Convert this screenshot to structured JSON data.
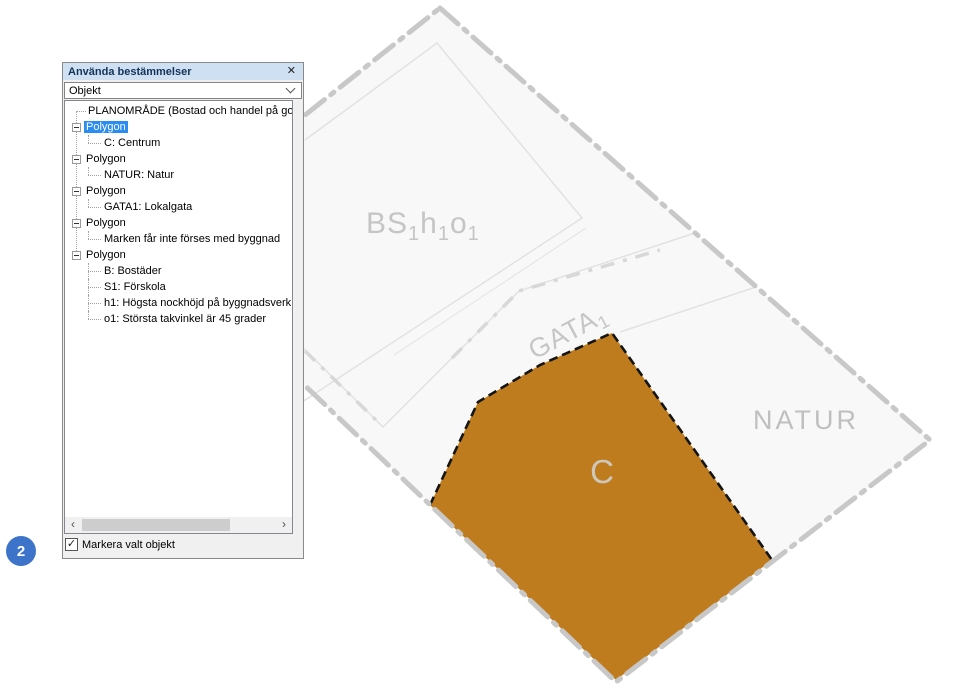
{
  "panel": {
    "title": "Använda bestämmelser",
    "object_selector": {
      "value": "Objekt"
    },
    "checkbox": {
      "label": "Markera valt objekt",
      "checked": true
    },
    "icons": {
      "close": "✕",
      "check": "✓",
      "scroll_left": "‹",
      "scroll_right": "›"
    }
  },
  "tree": {
    "items": [
      {
        "label": "PLANOMRÅDE (Bostad och handel på golfba",
        "type": "plain",
        "selected": false
      },
      {
        "label": "Polygon",
        "type": "node",
        "selected": true
      },
      {
        "label": "C: Centrum",
        "type": "leaf",
        "selected": false
      },
      {
        "label": "Polygon",
        "type": "node",
        "selected": false
      },
      {
        "label": "NATUR: Natur",
        "type": "leaf",
        "selected": false
      },
      {
        "label": "Polygon",
        "type": "node",
        "selected": false
      },
      {
        "label": "GATA1: Lokalgata",
        "type": "leaf",
        "selected": false
      },
      {
        "label": "Polygon",
        "type": "node",
        "selected": false
      },
      {
        "label": "Marken får inte förses med byggnad",
        "type": "leaf",
        "selected": false
      },
      {
        "label": "Polygon",
        "type": "node",
        "selected": false
      },
      {
        "label": "B: Bostäder",
        "type": "leaf",
        "selected": false
      },
      {
        "label": "S1: Förskola",
        "type": "leaf",
        "selected": false
      },
      {
        "label": "h1: Högsta nockhöjd på byggnadsverk",
        "type": "leaf",
        "selected": false
      },
      {
        "label": "o1: Största takvinkel är 45 grader",
        "type": "leaf",
        "selected": false
      }
    ]
  },
  "map": {
    "labels": {
      "bs": [
        "BS",
        "1",
        "h",
        "1",
        "o",
        "1"
      ],
      "gata": [
        "GATA",
        "1"
      ],
      "natur": "NATUR",
      "c": "C"
    },
    "colors": {
      "zone_c_fill": "#be7c1e",
      "boundary": "#c8c8c8",
      "zone_label": "#c5c5c5",
      "selection_border": "#151515"
    }
  },
  "annotation": {
    "badge": "2",
    "color": "#3d74ca"
  }
}
